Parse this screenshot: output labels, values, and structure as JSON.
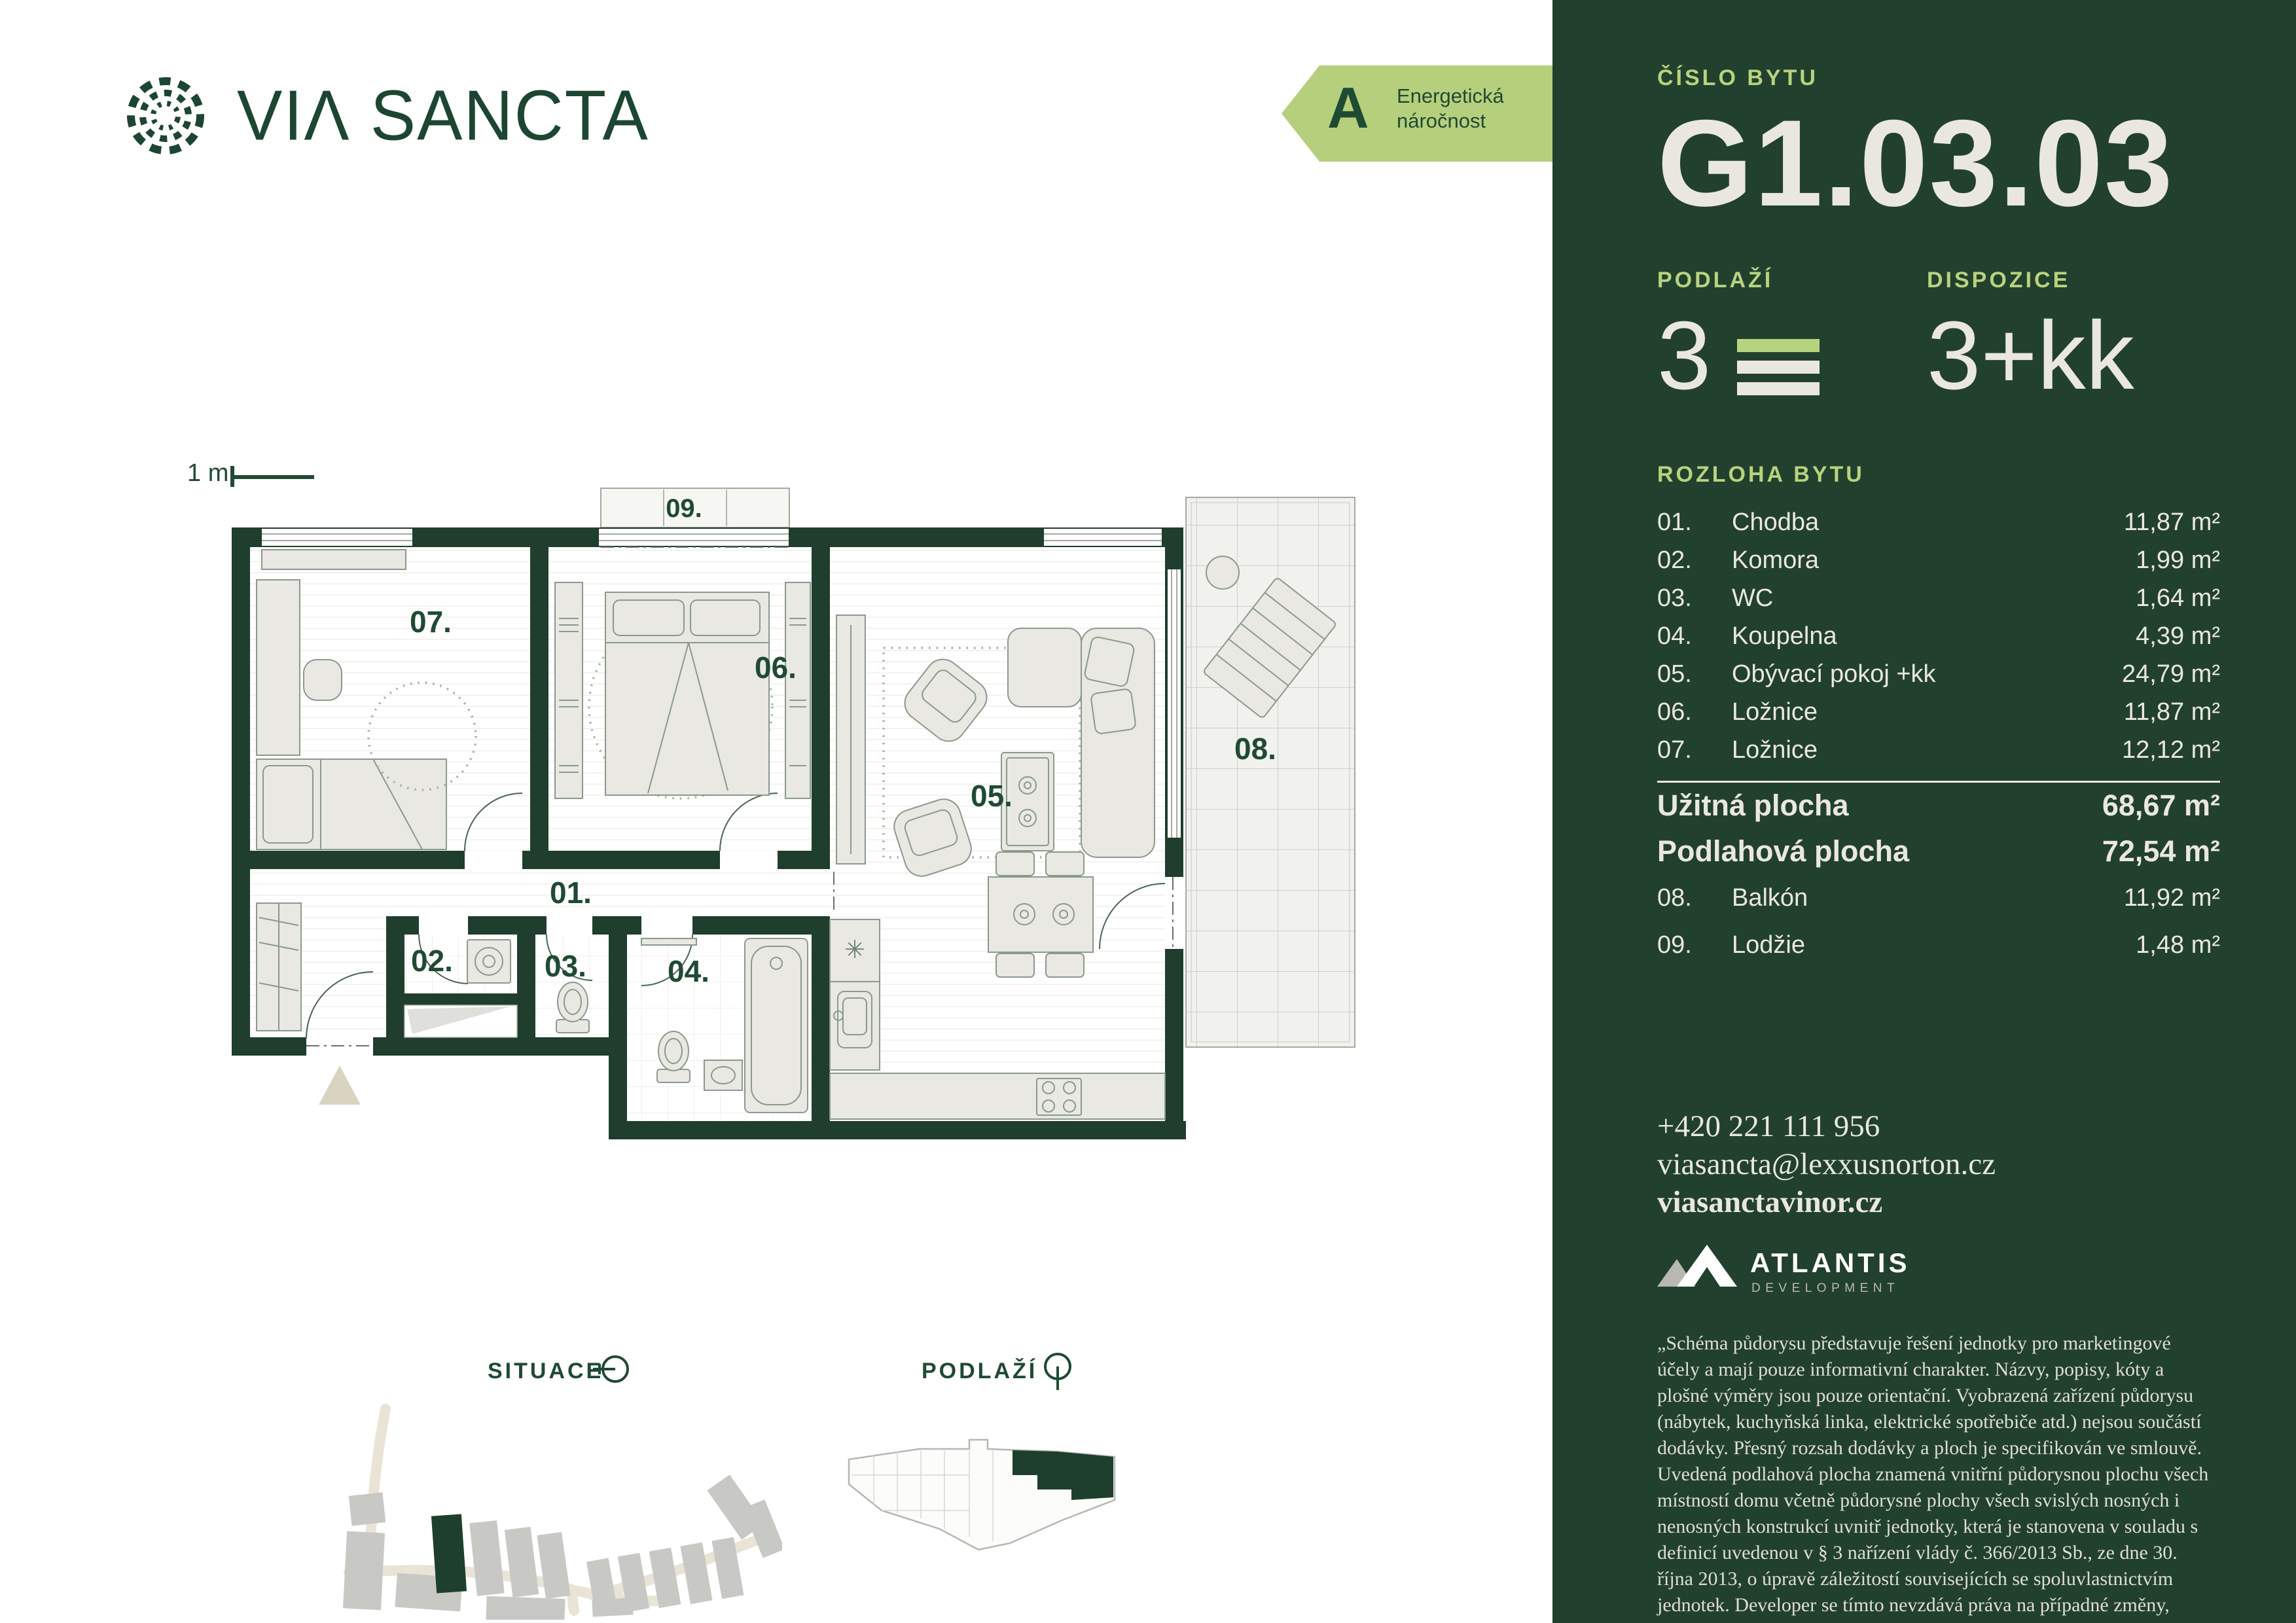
{
  "colors": {
    "panel_bg": "#22402e",
    "accent_light_green": "#b8d37e",
    "text_off_white": "#eae7e0",
    "brand_green": "#1d4632",
    "wall_green": "#1f3e2d",
    "label_green": "#1f4a33",
    "energy_badge_bg": "#b6cf7c",
    "road_beige": "#e9e4d6",
    "building_gray": "#c8c8c5"
  },
  "header": {
    "brand_word1": "VI",
    "brand_word1_a": "Λ",
    "brand_word2": "SANCTA"
  },
  "energy_badge": {
    "grade": "A",
    "line1": "Energetická",
    "line2": "náročnost"
  },
  "panel": {
    "unit_label": "ČÍSLO BYTU",
    "unit_number": "G1.03.03",
    "floor_label": "PODLAŽÍ",
    "floor_value": "3",
    "disposition_label": "DISPOZICE",
    "disposition_value": "3+kk",
    "area_section_label": "ROZLOHA BYTU",
    "rooms": [
      {
        "num": "01.",
        "name": "Chodba",
        "area": "11,87 m²"
      },
      {
        "num": "02.",
        "name": "Komora",
        "area": "1,99 m²"
      },
      {
        "num": "03.",
        "name": "WC",
        "area": "1,64 m²"
      },
      {
        "num": "04.",
        "name": "Koupelna",
        "area": "4,39 m²"
      },
      {
        "num": "05.",
        "name": "Obývací pokoj +kk",
        "area": "24,79 m²"
      },
      {
        "num": "06.",
        "name": "Ložnice",
        "area": "11,87 m²"
      },
      {
        "num": "07.",
        "name": "Ložnice",
        "area": "12,12 m²"
      }
    ],
    "summary": [
      {
        "label": "Užitná plocha",
        "area": "68,67 m²"
      },
      {
        "label": "Podlahová plocha",
        "area": "72,54 m²"
      }
    ],
    "exterior": [
      {
        "num": "08.",
        "name": "Balkón",
        "area": "11,92 m²"
      },
      {
        "num": "09.",
        "name": "Lodžie",
        "area": "1,48 m²"
      }
    ],
    "contact": {
      "phone": "+420 221 111 956",
      "email": "viasancta@lexxusnorton.cz",
      "website": "viasanctavinor.cz"
    },
    "developer": {
      "name": "ATLANTIS",
      "tagline": "DEVELOPMENT"
    },
    "disclaimer": "„Schéma půdorysu představuje řešení jednotky pro marketingové účely a mají pouze informativní charakter. Názvy, popisy, kóty a plošné výměry jsou pouze orientační. Vyobrazená zařízení půdorysu (nábytek, kuchyňská linka, elektrické spotřebiče atd.) nejsou součástí dodávky. Přesný rozsah dodávky a ploch je specifikován ve smlouvě. Uvedená podlahová plocha znamená vnitřní půdorysnou plochu všech místností domu včetně půdorysné plochy všech svislých nosných i nenosných konstrukcí uvnitř jednotky, která je stanovena v souladu s definicí uvedenou v § 3 nařízení vlády č. 366/2013 Sb., ze dne 30. října 2013, o úpravě záležitostí souvisejících se spoluvlastnictvím jednotek. Developer se tímto nevzdává práva na případné změny, úpravy či doplnění tohoto marketingového materiálu.“"
  },
  "floorplan": {
    "scale_label": "1 m",
    "labels": {
      "r01": "01.",
      "r02": "02.",
      "r03": "03.",
      "r04": "04.",
      "r05": "05.",
      "r06": "06.",
      "r07": "07.",
      "r08": "08.",
      "r09": "09."
    }
  },
  "footer": {
    "site_label": "SITUACE",
    "floor_label": "PODLAŽÍ"
  }
}
